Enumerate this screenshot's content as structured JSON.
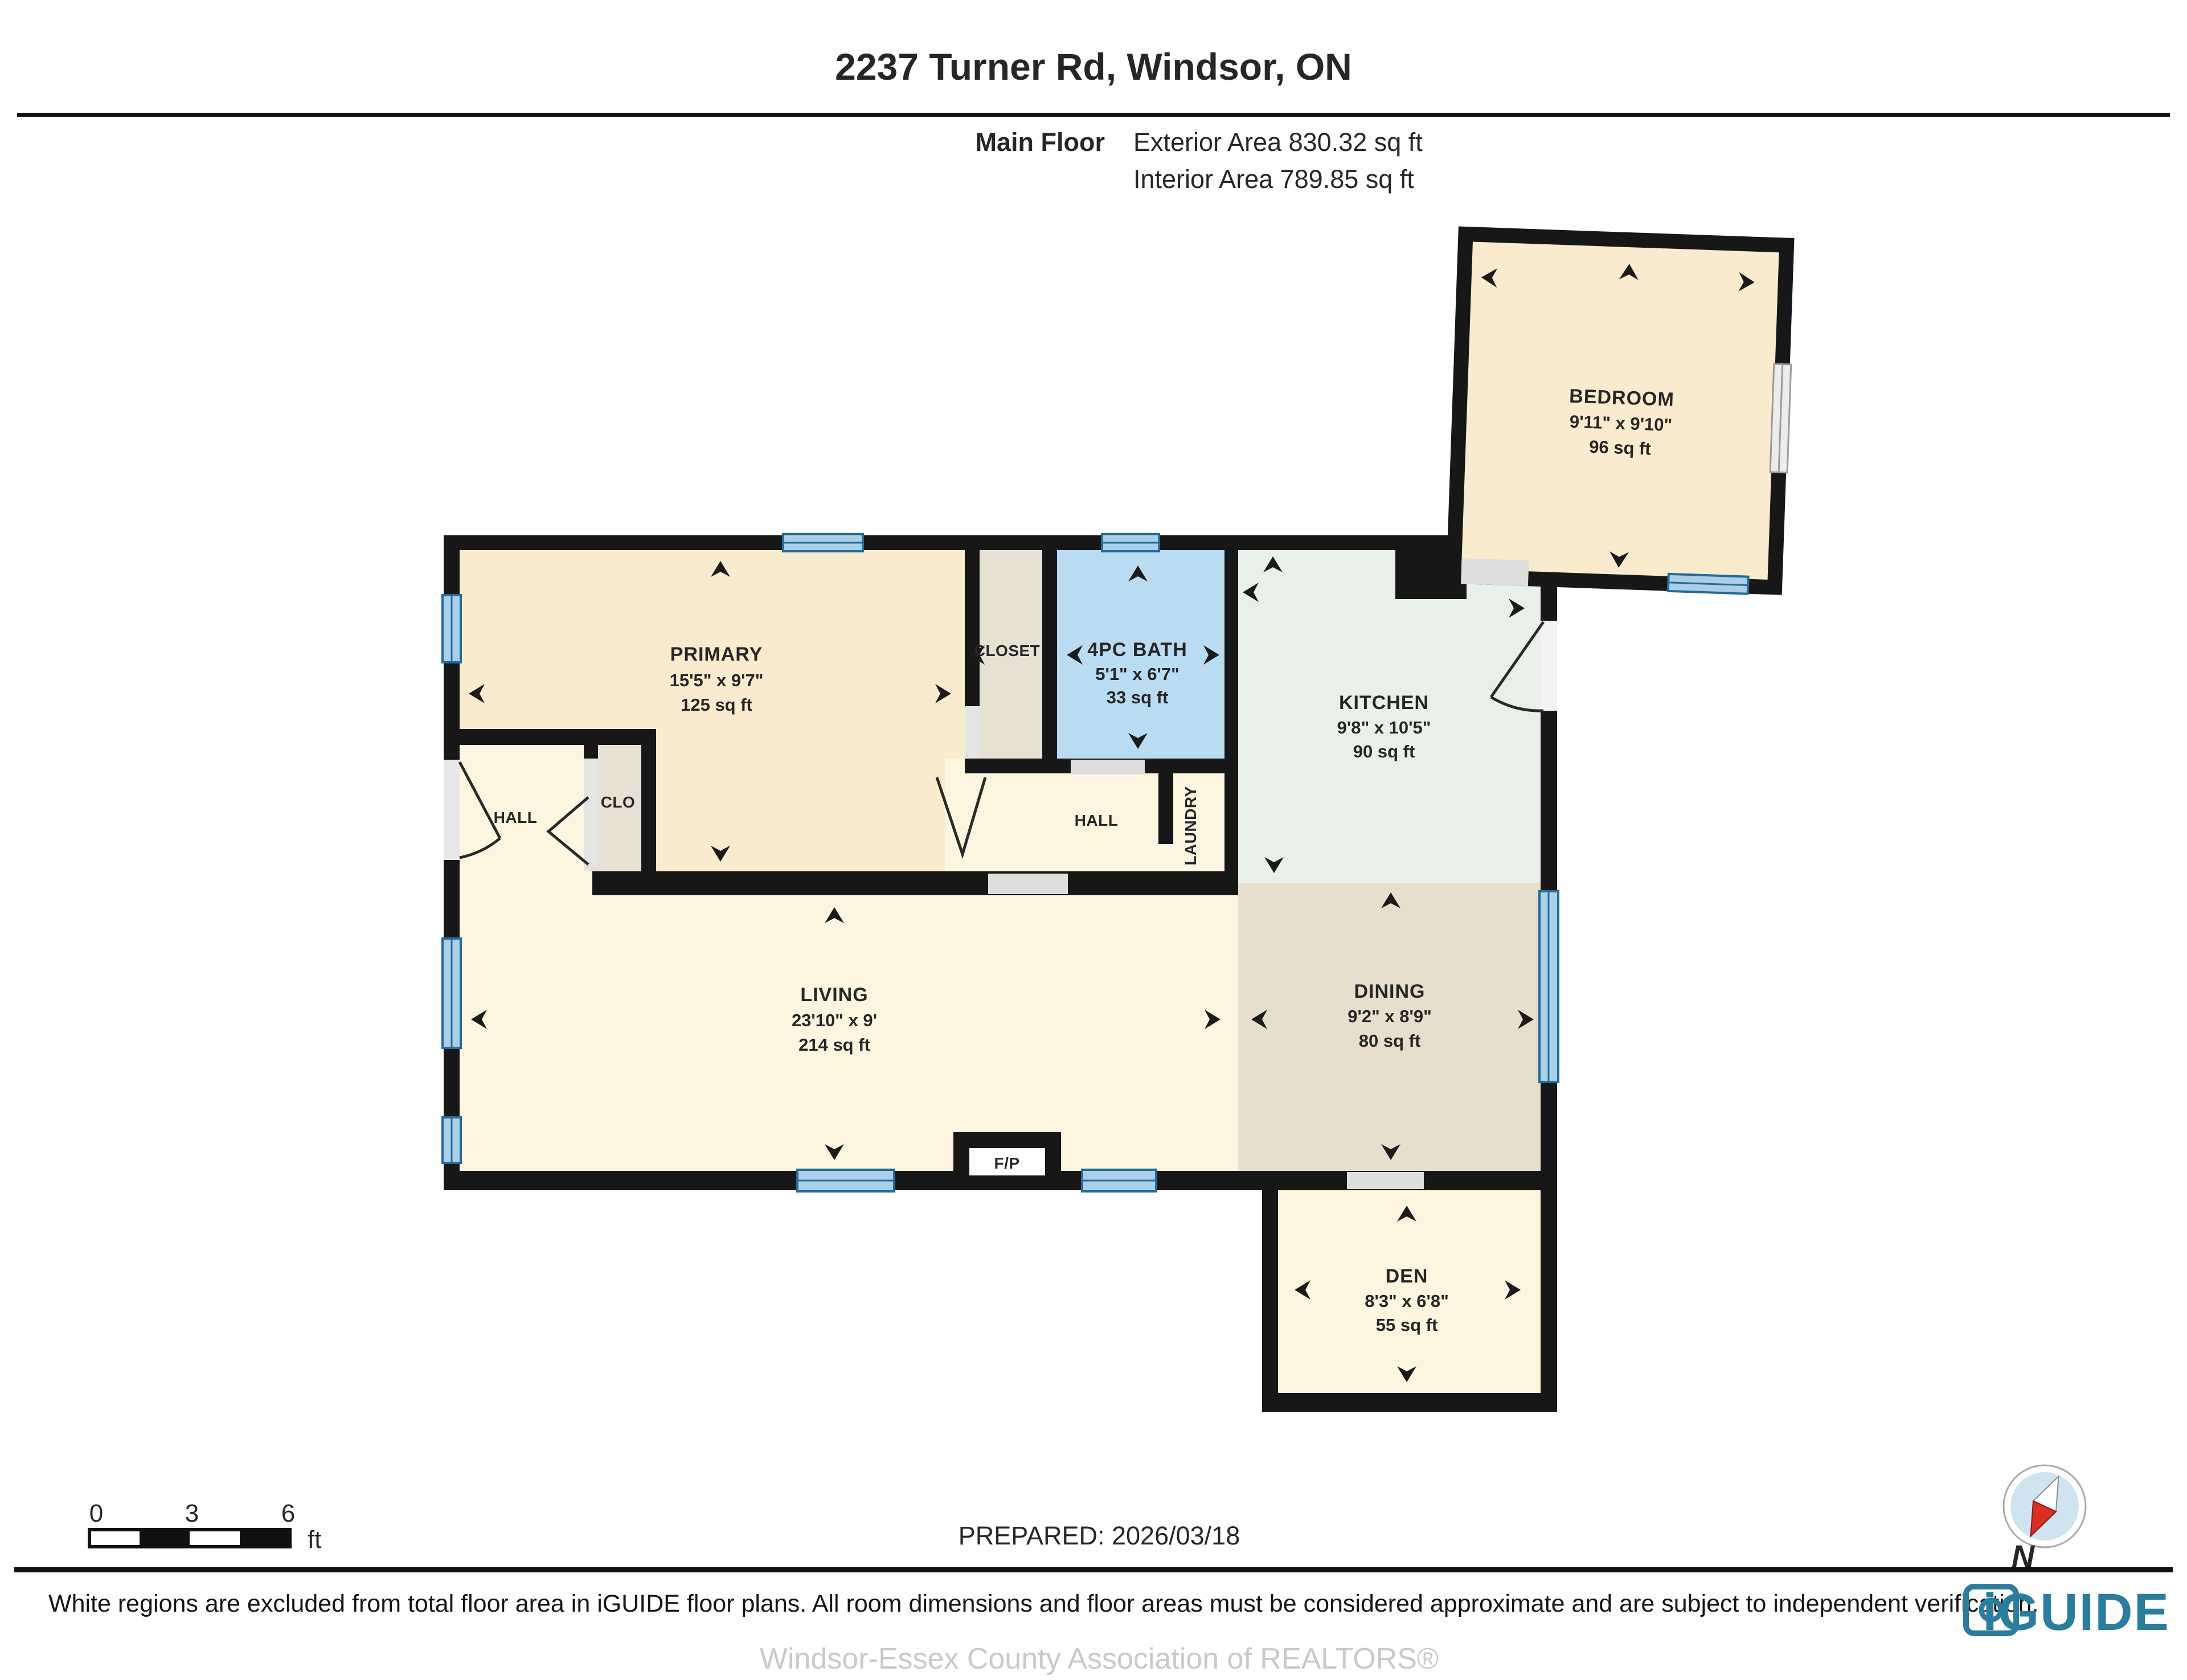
{
  "header": {
    "title": "2237 Turner Rd, Windsor, ON",
    "floor_label": "Main Floor",
    "exterior_area": "Exterior Area 830.32 sq ft",
    "interior_area": "Interior Area 789.85 sq ft"
  },
  "rooms": {
    "bedroom": {
      "name": "BEDROOM",
      "dims": "9'11\" x 9'10\"",
      "area": "96 sq ft"
    },
    "primary": {
      "name": "PRIMARY",
      "dims": "15'5\" x 9'7\"",
      "area": "125 sq ft"
    },
    "bath": {
      "name": "4PC BATH",
      "dims": "5'1\" x 6'7\"",
      "area": "33 sq ft"
    },
    "kitchen": {
      "name": "KITCHEN",
      "dims": "9'8\" x 10'5\"",
      "area": "90 sq ft"
    },
    "living": {
      "name": "LIVING",
      "dims": "23'10\" x 9'",
      "area": "214 sq ft"
    },
    "dining": {
      "name": "DINING",
      "dims": "9'2\" x 8'9\"",
      "area": "80 sq ft"
    },
    "den": {
      "name": "DEN",
      "dims": "8'3\" x 6'8\"",
      "area": "55 sq ft"
    }
  },
  "labels": {
    "closet": "CLOSET",
    "clo": "CLO",
    "hall_left": "HALL",
    "hall_center": "HALL",
    "laundry": "LAUNDRY",
    "fireplace": "F/P"
  },
  "scale_bar": {
    "ticks": [
      "0",
      "3",
      "6"
    ],
    "unit": "ft"
  },
  "footer": {
    "prepared": "PREPARED: 2026/03/18",
    "compass_label": "N",
    "disclaimer": "White regions are excluded from total floor area in iGUIDE floor plans. All room dimensions and floor areas must be considered approximate and are subject to independent verification.",
    "brand": "iGUIDE",
    "watermark": "Windsor-Essex County Association of REALTORS®"
  },
  "colors": {
    "wall": "#171717",
    "bedroom_fill": "#f9ebcd",
    "living_fill": "#fdf5e0",
    "closet_fill": "#e6e1d3",
    "bath_fill": "#b9dcf3",
    "kitchen_fill": "#e9efe9",
    "dining_fill": "#e7dfce",
    "window_blue": "#a9cfe9",
    "brand_teal": "#2b7d9c"
  }
}
